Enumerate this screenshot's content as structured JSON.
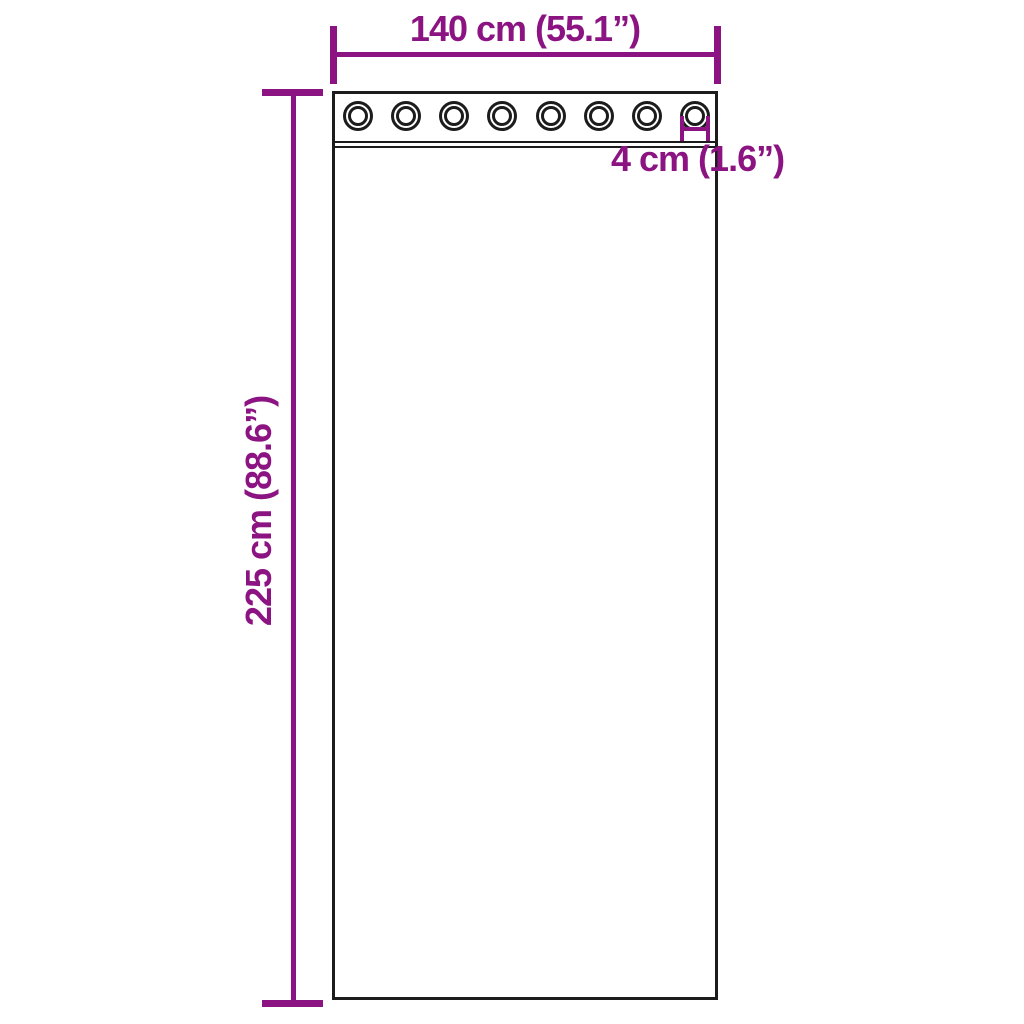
{
  "diagram": {
    "background_color": "#ffffff",
    "accent_color": "#8C1482",
    "outline_color": "#1c1c1c",
    "curtain": {
      "grommet_count": 8
    },
    "dimensions": {
      "width_label": "140 cm (55.1”)",
      "height_label": "225 cm (88.6”)",
      "grommet_label": "4 cm (1.6”)"
    }
  }
}
